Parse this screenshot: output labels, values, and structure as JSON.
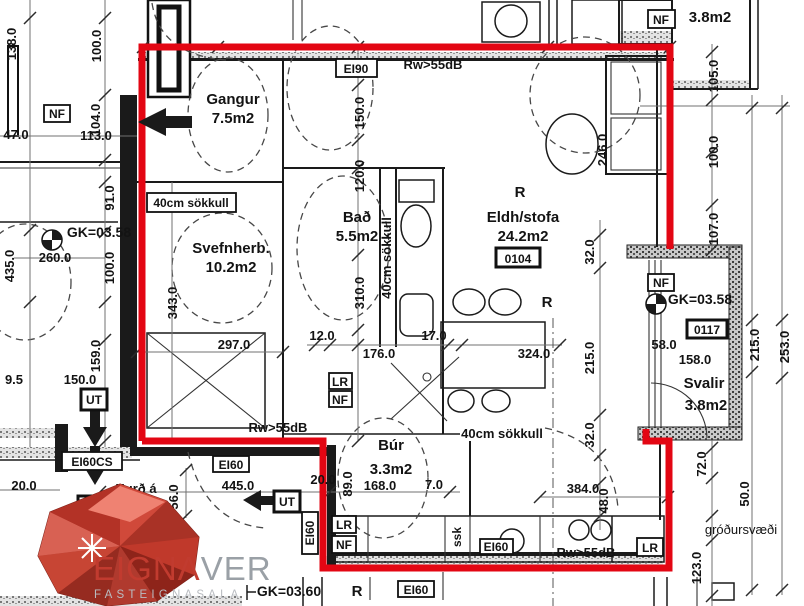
{
  "plan": {
    "rooms": {
      "gangur": {
        "name": "Gangur",
        "area": "7.5m2"
      },
      "svefnherb": {
        "name": "Svefnherb.",
        "area": "10.2m2"
      },
      "bad": {
        "name": "Bað",
        "area": "5.5m2"
      },
      "eldhus": {
        "name": "Eldh/stofa",
        "area": "24.2m2",
        "unit": "0104"
      },
      "bur": {
        "name": "Búr",
        "area": "3.3m2"
      },
      "svalir": {
        "name": "Svalir",
        "area": "3.8m2",
        "unit": "0117"
      },
      "nf_room": {
        "name": "NF",
        "area": "3.8m2"
      }
    },
    "levels": {
      "left": "GK=03.58",
      "right": "GK=03.58",
      "bottom": "GK=03.60"
    },
    "notes": {
      "sokkull": "40cm sökkull",
      "sound": "Rw>55dB",
      "door_line1": "Hurð á",
      "door_line2": "rafopnun",
      "garden": "gróðursvæði",
      "ssk": "ssk",
      "r": "R"
    },
    "tags": {
      "ei90": "EI90",
      "ei60": "EI60",
      "ei60cs": "EI60CS",
      "lr": "LR",
      "nf": "NF",
      "ut": "UT"
    },
    "dims": {
      "d138": "138.0",
      "d100_a": "100.0",
      "d104": "104.0",
      "d47": "47.0",
      "d113": "113.0",
      "d91": "91.0",
      "d100_b": "100.0",
      "d435": "435.0",
      "d260": "260.0",
      "d159": "159.0",
      "d9_5": "9.5",
      "d150_a": "150.0",
      "d20_a": "20.0",
      "d150_b": "150.0",
      "d120": "120.0",
      "d310": "310.0",
      "d343": "343.0",
      "d297": "297.0",
      "d12": "12.0",
      "d176": "176.0",
      "d17": "17.0",
      "d324": "324.0",
      "d246": "246.0",
      "d105": "105.0",
      "d100_c": "100.0",
      "d107": "107.0",
      "d32_a": "32.0",
      "d215_a": "215.0",
      "d58": "58.0",
      "d158": "158.0",
      "d215_b": "215.0",
      "d253": "253.0",
      "d32_b": "32.0",
      "d48": "48.0",
      "d384": "384.0",
      "d72": "72.0",
      "d50": "50.0",
      "d123": "123.0",
      "d445": "445.0",
      "d89": "89.0",
      "d168": "168.0",
      "d7": "7.0",
      "d56": "56.0",
      "d20_b": "20.0"
    },
    "colors": {
      "boundary": "#e30613",
      "logo_red": "#c13b2f",
      "logo_gray": "#9aa0a6"
    }
  },
  "logo": {
    "brand_primary": "EIGNΛ",
    "brand_secondary": "VER",
    "tagline": "FASTEIGNASALA"
  }
}
